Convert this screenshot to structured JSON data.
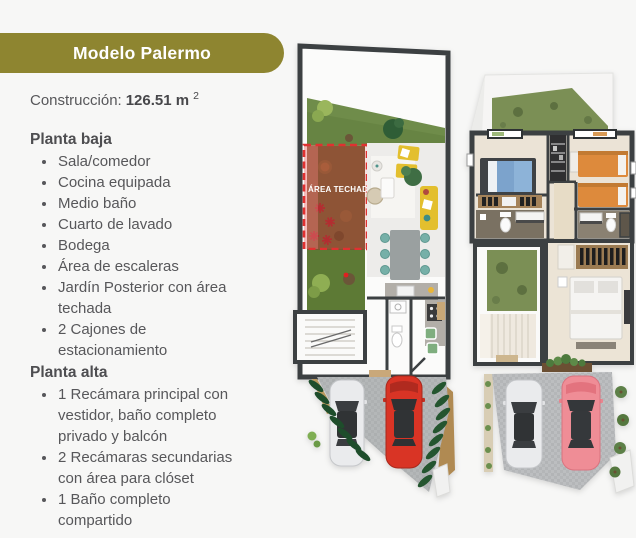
{
  "header": {
    "title": "Modelo Palermo"
  },
  "construction": {
    "label": "Construcción:",
    "value": "126.51 m",
    "superscript": "2"
  },
  "sections": {
    "planta_baja": {
      "heading": "Planta baja",
      "items": [
        "Sala/comedor",
        "Cocina equipada",
        "Medio baño",
        "Cuarto de lavado",
        "Bodega",
        "Área de escaleras",
        "Jardín Posterior con área techada",
        "2 Cajones de estacionamiento"
      ]
    },
    "planta_alta": {
      "heading": "Planta alta",
      "items": [
        "1 Recámara principal con vestidor, baño completo privado y balcón",
        "2 Recámaras secundarias con área para clóset",
        "1 Baño completo compartido"
      ]
    }
  },
  "floorplans": {
    "planta_baja_covered_area_label": "ÁREA TECHADA"
  },
  "colors": {
    "background": "#F7F7F6",
    "badge_olive": "#8E8530",
    "badge_text": "#FFFFFF",
    "body_text": "#57575A",
    "covered_area_red": "#E03131",
    "wall_dark": "#3C4042",
    "garden_green": "#6F8C4A",
    "garden_muted_green": "#7B8F55",
    "dirt_brown": "#7D5430",
    "sofa_yellow": "#E3BF2E",
    "chair_teal": "#76B0A8",
    "car_red": "#D93425",
    "car_white": "#EAEBED",
    "car_pink": "#EF8D96",
    "bed_blue": "#7CA3CC",
    "bed_orange": "#DD8A3C"
  }
}
